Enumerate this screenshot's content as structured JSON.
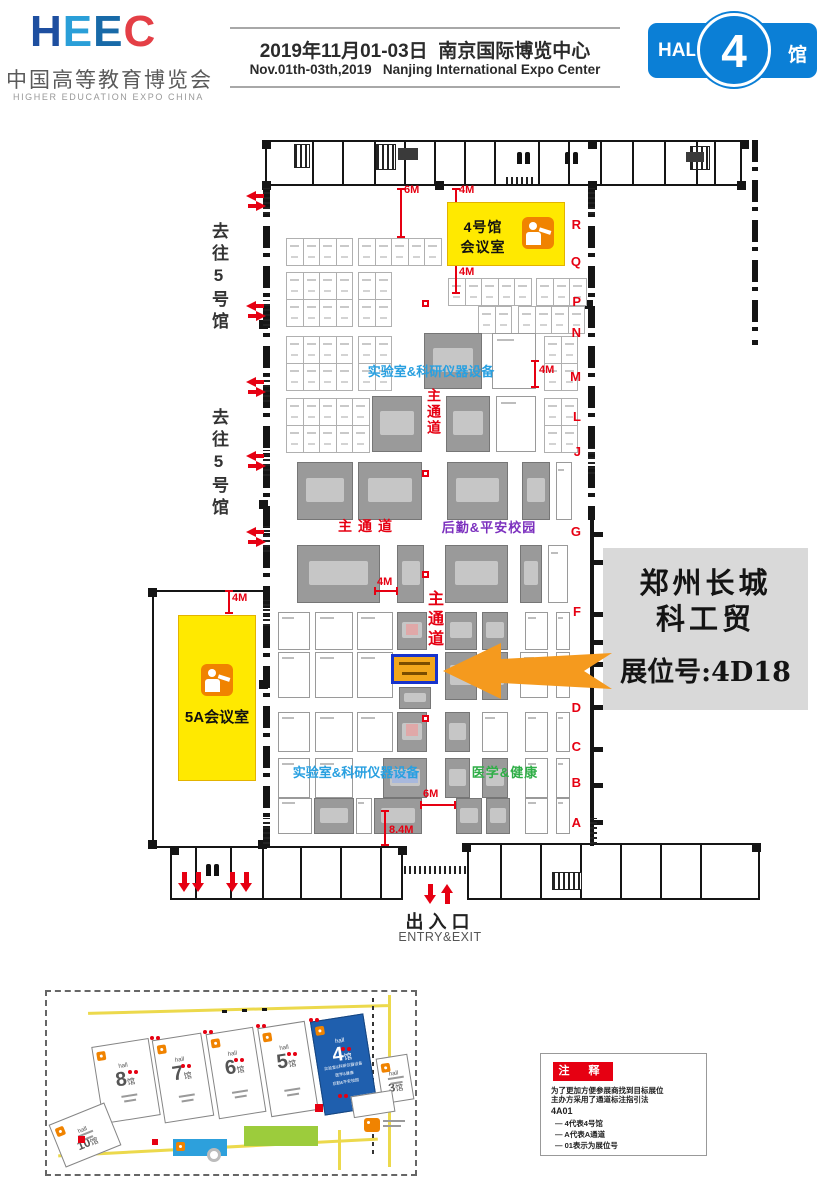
{
  "header": {
    "logo": {
      "wordmark": "HEEC",
      "title_cn": "中国高等教育博览会",
      "title_en": "HIGHER EDUCATION EXPO CHINA"
    },
    "event": {
      "date_cn": "2019年11月01-03日",
      "venue_cn": "南京国际博览中心",
      "date_en": "Nov.01th-03th,2019",
      "venue_en": "Nanjing International Expo Center"
    },
    "hall_badge": {
      "hall": "HALL",
      "number": "4",
      "suffix": "馆",
      "color": "#0b7fd6"
    }
  },
  "plan": {
    "corridor_label": "去往5号馆",
    "row_letters": [
      "R",
      "Q",
      "P",
      "N",
      "M",
      "L",
      "J",
      "G",
      "F",
      "E",
      "D",
      "C",
      "B",
      "A"
    ],
    "meeting_room_top": "4号馆\n会议室",
    "meeting_room_left": "5A会议室",
    "zone_labels": [
      {
        "text": "实验室&科研仪器设备",
        "color": "#29a0e0",
        "vertical": false
      },
      {
        "text": "主通道",
        "color": "#e60012",
        "vertical": true
      },
      {
        "text": "主通道",
        "color": "#e60012",
        "vertical": false
      },
      {
        "text": "后勤&平安校园",
        "color": "#7b2fbe",
        "vertical": false
      },
      {
        "text": "主通道",
        "color": "#e60012",
        "vertical": true
      },
      {
        "text": "实验室&科研仪器设备",
        "color": "#29a0e0",
        "vertical": false
      },
      {
        "text": "医学&健康",
        "color": "#2fae47",
        "vertical": false
      }
    ],
    "measurements": [
      "6M",
      "4M",
      "4M",
      "4M",
      "4M",
      "4M",
      "6M",
      "8.4M"
    ],
    "entry": {
      "cn": "出入口",
      "en": "ENTRY&EXIT"
    }
  },
  "callout": {
    "company_line1": "郑州长城",
    "company_line2": "科工贸",
    "booth": "展位号:4D18",
    "arrow_color": "#f59a1e"
  },
  "minimap": {
    "halls": [
      {
        "prefix": "hall",
        "number": "8",
        "suffix": "馆"
      },
      {
        "prefix": "hall",
        "number": "7",
        "suffix": "馆"
      },
      {
        "prefix": "hall",
        "number": "6",
        "suffix": "馆"
      },
      {
        "prefix": "hall",
        "number": "5",
        "suffix": "馆"
      },
      {
        "prefix": "hall",
        "number": "4",
        "suffix": "馆",
        "captions": [
          "实验室&科研仪器设备",
          "医学&健康",
          "后勤&平安校园"
        ]
      },
      {
        "prefix": "hall",
        "number": "3",
        "suffix": "馆"
      },
      {
        "prefix": "hall",
        "number": "10",
        "suffix": "馆"
      }
    ]
  },
  "legend": {
    "title": "注 释",
    "lines": [
      "为了更加方便参展商找到目标展位",
      "主办方采用了通道标注指引法",
      "4A01",
      "— 4代表4号馆",
      "— A代表A通道",
      "— 01表示为展位号"
    ]
  }
}
